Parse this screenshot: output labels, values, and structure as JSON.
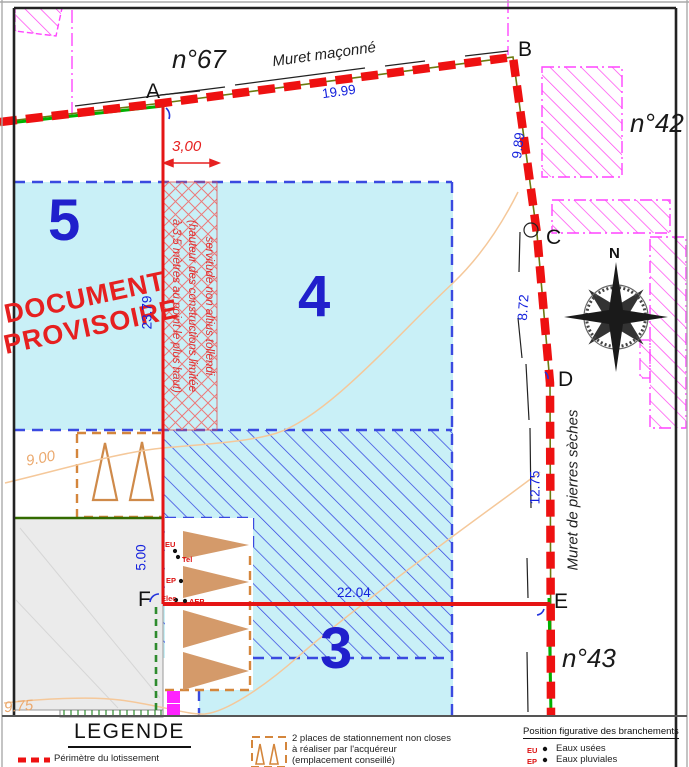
{
  "plan": {
    "parcels": {
      "n67": "n°67",
      "n42": "n°42",
      "n43": "n°43"
    },
    "lots": {
      "lot3": "3",
      "lot4": "4",
      "lot5": "5"
    },
    "watermark_line1": "DOCUMENT",
    "watermark_line2": "PROVISOIRE",
    "walls": {
      "masonry": "Muret maçonné",
      "dry_stone": "Muret de pierres sèches"
    },
    "points": {
      "a": "A",
      "b": "B",
      "c": "C",
      "d": "D",
      "e": "E",
      "f": "F"
    },
    "dims": {
      "ab": "19.99",
      "bc": "9.89",
      "cd": "8.72",
      "de": "12.75",
      "fe": "22.04",
      "af": "23.79",
      "f_gray": "5.00",
      "servitude_width": "3,00"
    },
    "contours": {
      "c9": "9.00",
      "c975": "9.75"
    },
    "servitude_text": {
      "line1": "servitude non altius tollendi",
      "line2": "(hauteur des constructions limitée",
      "line3": "à 3,5 mètres au point le plus haut)"
    },
    "compass_north": "N",
    "branchements": {
      "eu": "EU",
      "tel": "Tel",
      "ep": "EP",
      "elec": "Elec",
      "aep": "AEP"
    }
  },
  "legend": {
    "title": "LEGENDE",
    "perimeter_label": "Périmètre du lotissement",
    "parking_note_l1": "2 places de stationnement non closes",
    "parking_note_l2": "à réaliser par l'acquéreur",
    "parking_note_l3": "(emplacement conseillé)",
    "branchements_title": "Position figurative des branchements",
    "eu_label": "EU",
    "eu_text": "Eaux usées",
    "ep_label": "EP",
    "ep_text": "Eaux pluviales"
  },
  "colors": {
    "perimeter_red": "#ee1111",
    "lot_fill_cyan": "#c9f0f7",
    "lot_border_blue": "#3a4ae0",
    "boundary_green": "#00b000",
    "parcel_magenta": "#ff3df0",
    "contour_tan": "#f5c89a",
    "watermark_red": "#e62020",
    "lot_number_blue": "#2020cc"
  }
}
